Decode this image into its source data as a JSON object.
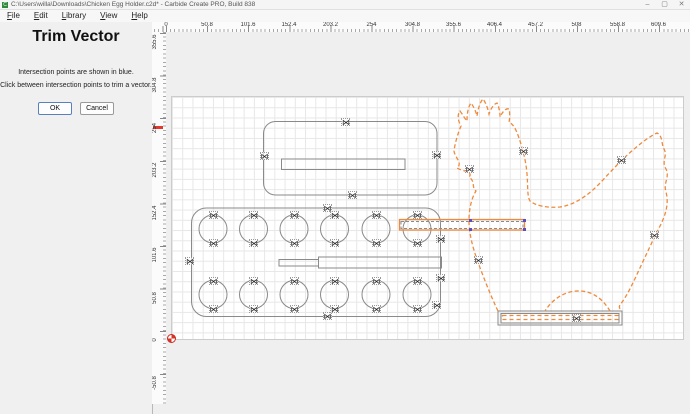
{
  "window": {
    "title": "C:\\Users\\willa\\Downloads\\Chicken Egg Holder.c2d* - Carbide Create PRO, Build 838",
    "app_icon": "C",
    "controls": {
      "minimize": "–",
      "maximize": "▢",
      "close": "✕"
    }
  },
  "menu": {
    "items": [
      "File",
      "Edit",
      "Library",
      "View",
      "Help"
    ]
  },
  "panel": {
    "title": "Trim Vector",
    "instruction_line1": "Intersection points are shown in blue.",
    "instruction_line2": "Click between intersection points to trim a vector.",
    "ok_label": "OK",
    "cancel_label": "Cancel"
  },
  "rulers": {
    "top_units_mm": [
      {
        "label": "0",
        "x": 166
      },
      {
        "label": "50.8",
        "x": 207
      },
      {
        "label": "101.6",
        "x": 248
      },
      {
        "label": "152.4",
        "x": 289
      },
      {
        "label": "203.2",
        "x": 330.5
      },
      {
        "label": "254",
        "x": 371.5
      },
      {
        "label": "304.8",
        "x": 412.5
      },
      {
        "label": "355.6",
        "x": 453.5
      },
      {
        "label": "406.4",
        "x": 494.5
      },
      {
        "label": "457.2",
        "x": 535.5
      },
      {
        "label": "508",
        "x": 576.5
      },
      {
        "label": "558.8",
        "x": 617.5
      },
      {
        "label": "609.6",
        "x": 658.5
      }
    ],
    "left_units_mm": [
      {
        "label": "355.6",
        "y": 42
      },
      {
        "label": "304.8",
        "y": 85
      },
      {
        "label": "254",
        "y": 127.5
      },
      {
        "label": "203.2",
        "y": 170
      },
      {
        "label": "152.4",
        "y": 212.5
      },
      {
        "label": "101.6",
        "y": 255
      },
      {
        "label": "50.8",
        "y": 297.5
      },
      {
        "label": "0",
        "y": 340
      },
      {
        "label": "-50.8",
        "y": 382.5
      }
    ],
    "cursor_indicator_y": 127.5
  },
  "canvas": {
    "colors": {
      "vector_gray": "#8a8a8a",
      "selected_orange": "#ef8a3c",
      "intersection_blue": "#5b4fc0",
      "grid": "#e7e7e7",
      "stock": "#ffffff",
      "outside_stock": "#efefef",
      "origin_red": "#d9362a"
    },
    "marker_glyph": "⋈",
    "node_markers": [
      [
        345.5,
        121.5
      ],
      [
        264,
        155.5
      ],
      [
        436.5,
        154.5
      ],
      [
        352,
        194.5
      ],
      [
        327,
        208
      ],
      [
        189.5,
        260.5
      ],
      [
        440.5,
        238.5
      ],
      [
        440.5,
        277.5
      ],
      [
        436.5,
        305
      ],
      [
        327,
        316
      ],
      [
        213,
        215
      ],
      [
        253.5,
        215
      ],
      [
        294,
        215
      ],
      [
        334.5,
        215
      ],
      [
        376,
        215
      ],
      [
        417,
        215
      ],
      [
        213,
        243
      ],
      [
        253.5,
        243
      ],
      [
        294,
        243
      ],
      [
        334.5,
        243
      ],
      [
        376,
        243
      ],
      [
        417,
        243
      ],
      [
        213,
        280.5
      ],
      [
        253.5,
        280.5
      ],
      [
        294,
        280.5
      ],
      [
        334.5,
        280.5
      ],
      [
        376,
        280.5
      ],
      [
        417,
        280.5
      ],
      [
        213,
        308.5
      ],
      [
        253.5,
        308.5
      ],
      [
        294,
        308.5
      ],
      [
        334.5,
        308.5
      ],
      [
        376,
        308.5
      ],
      [
        417,
        308.5
      ],
      [
        469,
        169
      ],
      [
        523,
        151
      ],
      [
        621,
        160
      ],
      [
        654,
        235
      ],
      [
        478,
        260
      ],
      [
        576,
        318
      ]
    ],
    "intersection_points": [
      [
        470,
        220.5
      ],
      [
        524,
        220.5
      ],
      [
        470,
        229.5
      ],
      [
        524,
        229.5
      ]
    ],
    "origin_point": {
      "x": 171,
      "y": 338
    }
  }
}
